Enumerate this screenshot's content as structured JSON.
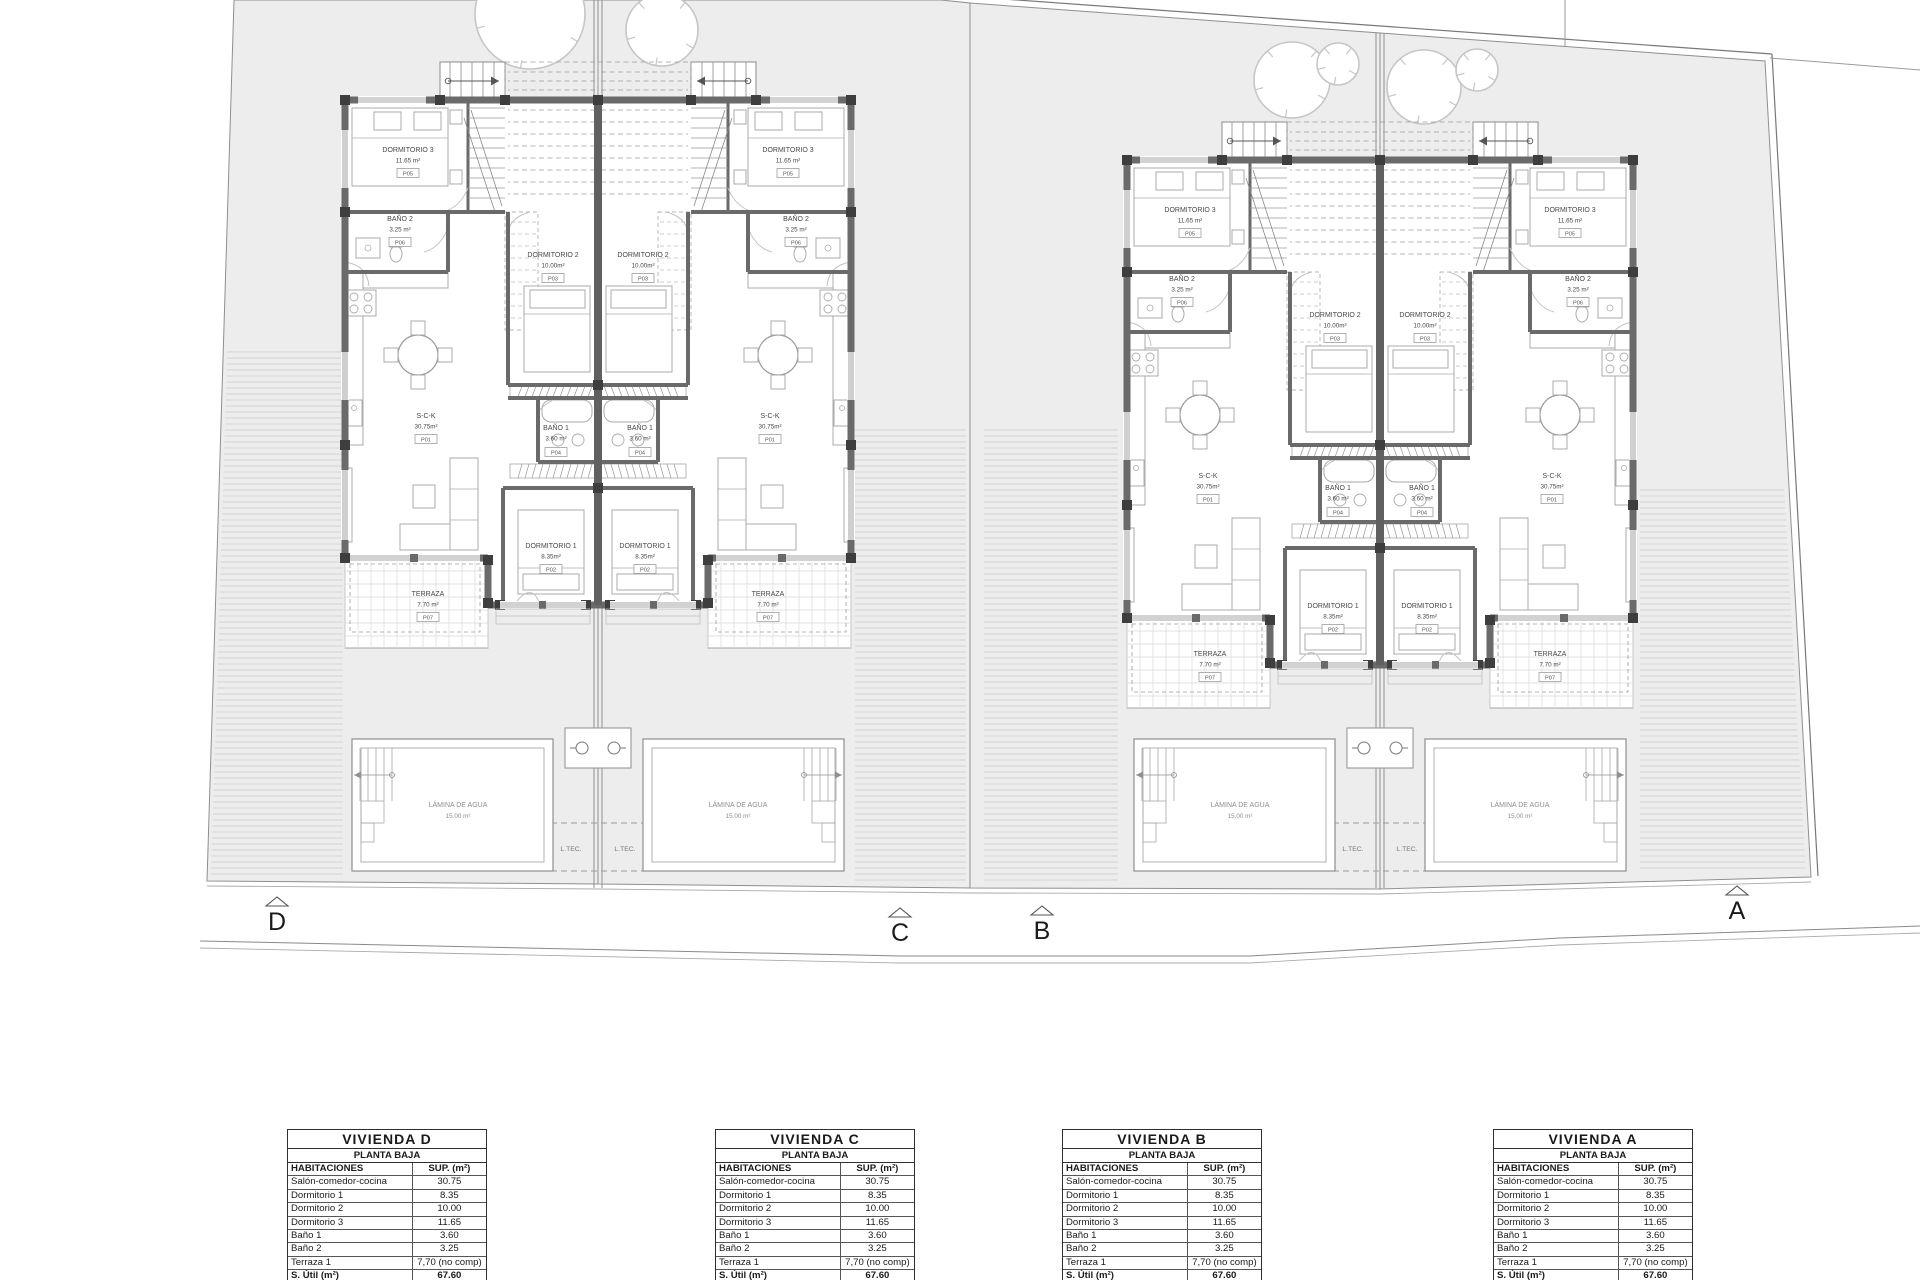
{
  "plan": {
    "section_markers": [
      "D",
      "C",
      "B",
      "A"
    ],
    "ltec_label": "L.TEC.",
    "unit_rooms": {
      "sck": {
        "name": "S-C-K",
        "area": "30.75m²",
        "code": "P01"
      },
      "dorm1": {
        "name": "DORMITORIO 1",
        "area": "8.35m²",
        "code": "P02"
      },
      "dorm2": {
        "name": "DORMITORIO 2",
        "area": "10.00m²",
        "code": "P03"
      },
      "bath1": {
        "name": "BAÑO 1",
        "area": "3.60 m²",
        "code": "P04"
      },
      "dorm3": {
        "name": "DORMITORIO 3",
        "area": "11.65 m²",
        "code": "P05"
      },
      "bath2": {
        "name": "BAÑO 2",
        "area": "3.25 m²",
        "code": "P06"
      },
      "terrace": {
        "name": "TERRAZA",
        "area": "7.70 m²",
        "code": "P07"
      },
      "pool": {
        "name": "LÁMINA DE AGUA",
        "area": "15.00 m²"
      }
    }
  },
  "tables": [
    {
      "title": "VIVIENDA D",
      "subtitle": "PLANTA BAJA",
      "col_headers": [
        "HABITACIONES",
        "SUP. (m²)"
      ],
      "rows": [
        [
          "Salón-comedor-cocina",
          "30.75"
        ],
        [
          "Dormitorio 1",
          "8.35"
        ],
        [
          "Dormitorio 2",
          "10.00"
        ],
        [
          "Dormitorio 3",
          "11.65"
        ],
        [
          "Baño 1",
          "3.60"
        ],
        [
          "Baño 2",
          "3.25"
        ],
        [
          "Terraza 1",
          "7,70 (no comp)"
        ]
      ],
      "total_label": "S. Útil (m²)",
      "total_value": "67.60"
    },
    {
      "title": "VIVIENDA C",
      "subtitle": "PLANTA BAJA",
      "col_headers": [
        "HABITACIONES",
        "SUP. (m²)"
      ],
      "rows": [
        [
          "Salón-comedor-cocina",
          "30.75"
        ],
        [
          "Dormitorio 1",
          "8.35"
        ],
        [
          "Dormitorio 2",
          "10.00"
        ],
        [
          "Dormitorio 3",
          "11.65"
        ],
        [
          "Baño 1",
          "3.60"
        ],
        [
          "Baño 2",
          "3.25"
        ],
        [
          "Terraza 1",
          "7,70 (no comp)"
        ]
      ],
      "total_label": "S. Útil (m²)",
      "total_value": "67.60"
    },
    {
      "title": "VIVIENDA B",
      "subtitle": "PLANTA BAJA",
      "col_headers": [
        "HABITACIONES",
        "SUP. (m²)"
      ],
      "rows": [
        [
          "Salón-comedor-cocina",
          "30.75"
        ],
        [
          "Dormitorio 1",
          "8.35"
        ],
        [
          "Dormitorio 2",
          "10.00"
        ],
        [
          "Dormitorio 3",
          "11.65"
        ],
        [
          "Baño 1",
          "3.60"
        ],
        [
          "Baño 2",
          "3.25"
        ],
        [
          "Terraza 1",
          "7,70 (no comp)"
        ]
      ],
      "total_label": "S. Útil (m²)",
      "total_value": "67.60"
    },
    {
      "title": "VIVIENDA A",
      "subtitle": "PLANTA BAJA",
      "col_headers": [
        "HABITACIONES",
        "SUP. (m²)"
      ],
      "rows": [
        [
          "Salón-comedor-cocina",
          "30.75"
        ],
        [
          "Dormitorio 1",
          "8.35"
        ],
        [
          "Dormitorio 2",
          "10.00"
        ],
        [
          "Dormitorio 3",
          "11.65"
        ],
        [
          "Baño 1",
          "3.60"
        ],
        [
          "Baño 2",
          "3.25"
        ],
        [
          "Terraza 1",
          "7,70 (no comp)"
        ]
      ],
      "total_label": "S. Útil (m²)",
      "total_value": "67.60"
    }
  ],
  "colors": {
    "parcel_fill": "#ededed",
    "wall": "#6a6a6a",
    "wall_dark": "#3e3e3e",
    "boundary": "#8f8f8f",
    "hatch": "#c9c9c9",
    "grid": "#d9d9d9",
    "dash": "#9c9c9c",
    "furniture": "#ababab",
    "label_text": "#474747",
    "table_border": "#2e2e2e"
  }
}
